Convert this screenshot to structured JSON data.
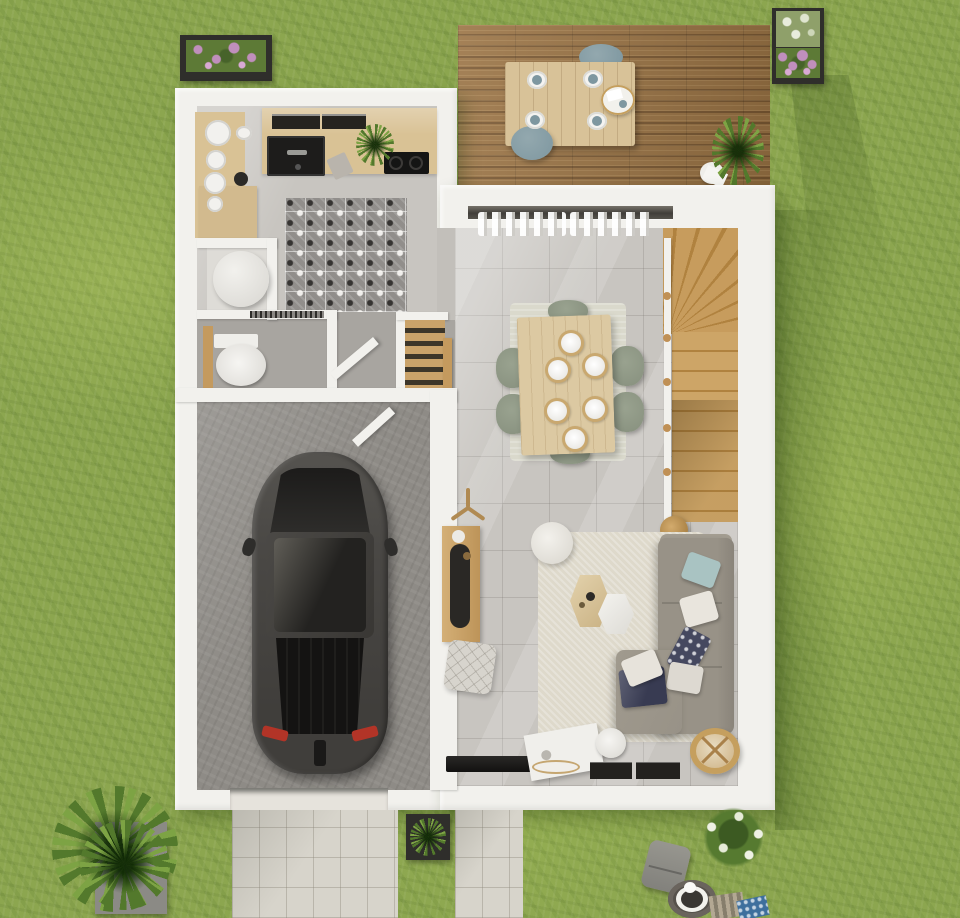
{
  "title": "3d-floor-plan-render-ground-floor",
  "colors": {
    "grass": "#8CA64F",
    "wall": "#F2F1ED",
    "livingFloor": "#C8C5C0",
    "hallFloor": "#A8A5A0",
    "garageFloor": "#8E8B86",
    "kitchenWood": "#D9C295",
    "tileBase": "#918E8B",
    "deckWood": "#9A7344",
    "deckWoodDark": "#7A5832",
    "deckTable": "#D8C298",
    "blueSeat": "#7E97A0",
    "stairWood": "#C79C5D",
    "stairWoodDark": "#B0823F",
    "doorWood": "#C49A5E",
    "tableWood": "#DCC9A2",
    "chairSage": "#87907E",
    "diningRug": "#DAD9CC",
    "livingRug": "#DED9CB",
    "sofa": "#989287",
    "sofaDark": "#8A847A",
    "pillowBlue": "#A9C3C2",
    "pillowNavy": "#45485F",
    "carBody": "#4A4845",
    "taillight": "#B23427",
    "driveway": "#D7D4CB",
    "planterBox": "#2F2E2B",
    "flowerPink": "#C08FBC",
    "plantGreen": "#53792C",
    "plantGreenLight": "#7DA344",
    "rattan": "#C59F5E",
    "firepit": "#56514B",
    "matStripe": "#B3A893",
    "blueMat": "#3E6F9D"
  },
  "scene": {
    "outdoor_objects": [
      "lawn",
      "wood-deck",
      "outdoor-dining-table",
      "outdoor-chairs",
      "serving-tray",
      "potted-plant",
      "flower-planter-top-left",
      "flower-planter-top-right",
      "grass-palm-in-pot",
      "flowering-bush",
      "lounge-chair",
      "fire-pit",
      "door-mats",
      "driveway",
      "front-path",
      "boxwood-planter"
    ],
    "indoor_objects": [
      "kitchen-counter",
      "kitchen-sink",
      "cooktop",
      "dish-cabinet",
      "patterned-cement-tiles",
      "water-heater",
      "toilet",
      "pantry-shelves",
      "entry-door",
      "interior-doors",
      "garage",
      "car",
      "winder-staircase",
      "stair-railing",
      "dining-table",
      "six-plates",
      "six-chairs",
      "dining-rug",
      "l-shaped-sofa",
      "throw-pillows",
      "hexagonal-coffee-tables",
      "round-pouf",
      "quilted-pouf",
      "sideboard",
      "coat-stand",
      "wall-tv",
      "media-cabinet",
      "rattan-chair",
      "curtains",
      "sliding-glass-door"
    ]
  }
}
